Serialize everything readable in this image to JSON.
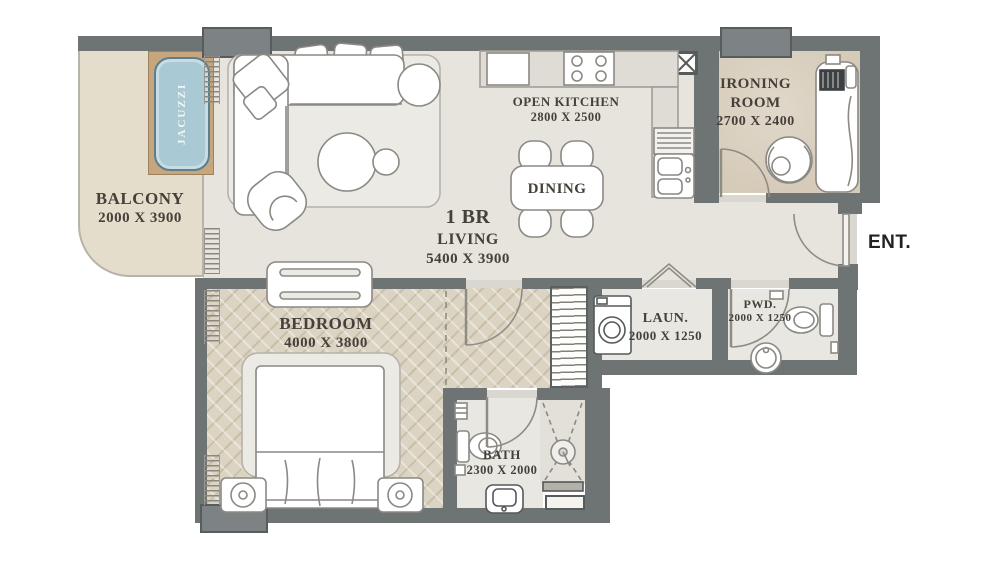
{
  "plan_title": "1 BR apartment floor plan",
  "rooms": {
    "balcony": {
      "label": "BALCONY",
      "dims": "2000 X 3900"
    },
    "living": {
      "label_line1": "1 BR",
      "label_line2": "LIVING",
      "dims": "5400 X 3900"
    },
    "kitchen": {
      "label": "OPEN KITCHEN",
      "dims": "2800 X 2500"
    },
    "dining": {
      "label": "DINING"
    },
    "ironing": {
      "label_line1": "IRONING",
      "label_line2": "ROOM",
      "dims": "2700 X 2400"
    },
    "bedroom": {
      "label": "BEDROOM",
      "dims": "4000 X 3800"
    },
    "laundry": {
      "label": "LAUN.",
      "dims": "2000 X 1250"
    },
    "powder": {
      "label": "PWD.",
      "dims": "2000 X 1250"
    },
    "bath": {
      "label": "BATH",
      "dims": "2300 X 2000"
    }
  },
  "fixtures": {
    "jacuzzi_label": "JACUZZI"
  },
  "entrance": {
    "label": "ENT."
  },
  "colors": {
    "wall": "#6e7374",
    "column": "#7d8384",
    "floor_main": "#e6e4dd",
    "floor_balcony": "#e4ddcc",
    "floor_ironing": "#d6cbb9",
    "floor_bedroom": "#dcd4c3",
    "floor_bath": "#e9e7e2",
    "jacuzzi_water": "#a9cad5",
    "jacuzzi_deck": "#c6a77d",
    "label_text": "#45403a"
  }
}
